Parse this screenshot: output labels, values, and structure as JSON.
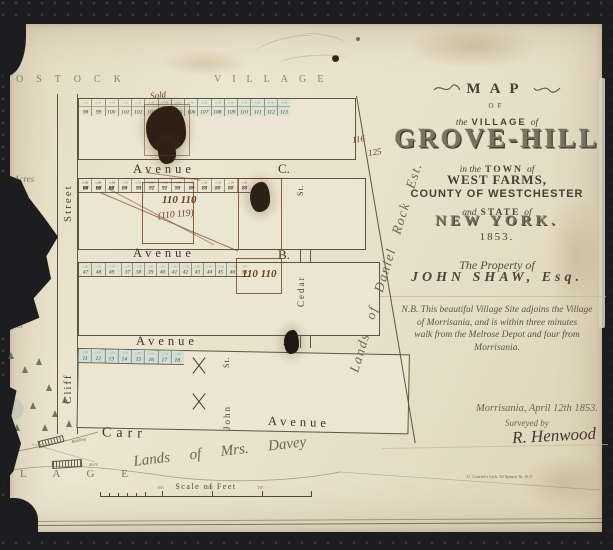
{
  "bands": {
    "top_left": "OSTOCK",
    "top_right": "VILLAGE",
    "bottom_partial": "L A G E"
  },
  "title_block": {
    "map_word": "MAP",
    "of_word": "OF",
    "village_pre": "the",
    "village_main": "VILLAGE",
    "village_post": "of",
    "name": "GROVE-HILL",
    "town_pre": "in the",
    "town_main": "TOWN",
    "town_post": "of",
    "west_farms": "WEST FARMS,",
    "county": "COUNTY OF WESTCHESTER",
    "state_pre": "and",
    "state_main": "STATE",
    "state_post": "of",
    "new_york": "NEW YORK.",
    "year": "1853.",
    "property_of": "The Property of",
    "owner": "JOHN SHAW, Esq.",
    "note_lines": [
      "N.B. This beautiful Village Site adjoins the Village",
      "of Morrisania, and is within three minutes",
      "walk from the Melrose Depot and four from",
      "Morrisania."
    ],
    "dateline": "Morrisania, April 12th 1853.",
    "surveyed_by": "Surveyed by",
    "surveyor": "R. Henwood",
    "lith_credit": "C. Currier's Lith. 33 Spruce St. N.Y."
  },
  "map": {
    "streets": {
      "west": "Street",
      "cliff": "Cliff",
      "cedar": "Cedar",
      "cedar_st": "St.",
      "john": "John",
      "john_st": "St.",
      "avenue_word": "Avenue",
      "avenue_c": "C.",
      "avenue_b": "B.",
      "avenue_a": "A.",
      "carr": "Carr",
      "carr_avenue": "Avenue"
    },
    "lands": {
      "east": "Lands of Daniel Rock Est.",
      "south": "Lands of Mrs. Davey",
      "acres": "Acres",
      "lots": "Lots"
    },
    "buildings": {
      "b1": "Building",
      "b2": "Store"
    },
    "scale": {
      "label": "Scale of Feet",
      "ticks": [
        "100",
        "200",
        "300"
      ]
    },
    "annotations": {
      "sold": "Sold",
      "n116": "116",
      "n125": "125",
      "b2_top": "110 110",
      "b2_bottom": "(110 119)",
      "b3": "110 110"
    },
    "blocks": [
      {
        "price": "2.50",
        "segments": [
          {
            "tints": [
              "b1grad"
            ],
            "rows": [
              [
                "98",
                "99",
                "100",
                "101",
                "102",
                "103",
                "104",
                "105",
                "106",
                "107",
                "108",
                "109",
                "110",
                "111",
                "112",
                "113"
              ]
            ]
          }
        ]
      },
      {
        "price": "1.50",
        "segments": [
          {
            "tints": [
              "",
              ""
            ],
            "rows": [
              [
                "97",
                "96",
                "95",
                "94",
                "93",
                "92",
                "91",
                "90",
                "89",
                "88",
                "87",
                "86",
                "85"
              ],
              [
                "66",
                "67",
                "68",
                "69",
                "70",
                "71",
                "72",
                "73",
                "74",
                "75",
                "76",
                "77",
                "78"
              ]
            ]
          },
          {
            "tints": [
              "",
              ""
            ],
            "rows": [
              [
                "84",
                "83",
                "82"
              ],
              [
                "79",
                "80",
                "81"
              ]
            ]
          }
        ]
      },
      {
        "price": "1.00",
        "segments": [
          {
            "tints": [
              "",
              "tint-a"
            ],
            "rows": [
              [
                "65",
                "64",
                "63",
                "62",
                "61",
                "60",
                "59",
                "58",
                "57",
                "56",
                "55",
                "54",
                "53"
              ],
              [
                "HOUSE",
                "35",
                "36",
                "37",
                "38",
                "39",
                "40",
                "41",
                "42",
                "43",
                "44",
                "45",
                "46"
              ]
            ]
          },
          {
            "tints": [
              "",
              "tint-a"
            ],
            "rows": [
              [
                "52",
                "51",
                "50"
              ],
              [
                "47",
                "48",
                "49"
              ]
            ]
          }
        ]
      },
      {
        "price": "1.50",
        "segments": [
          {
            "tints": [
              "tint-b",
              "tint-c"
            ],
            "rows": [
              [
                "34",
                "33",
                "32",
                "31",
                "30",
                "29",
                "28",
                "27"
              ],
              [
                "3",
                "4",
                "5",
                "6",
                "7",
                "8",
                "9",
                "10"
              ]
            ]
          },
          {
            "tints": [
              "tint-b",
              "tint-c"
            ],
            "rows": [
              [
                "26",
                "25",
                "24",
                "23",
                "22",
                "21",
                "20",
                "19"
              ],
              [
                "11",
                "12",
                "13",
                "14",
                "15",
                "16",
                "17",
                "18"
              ]
            ]
          }
        ]
      }
    ]
  }
}
